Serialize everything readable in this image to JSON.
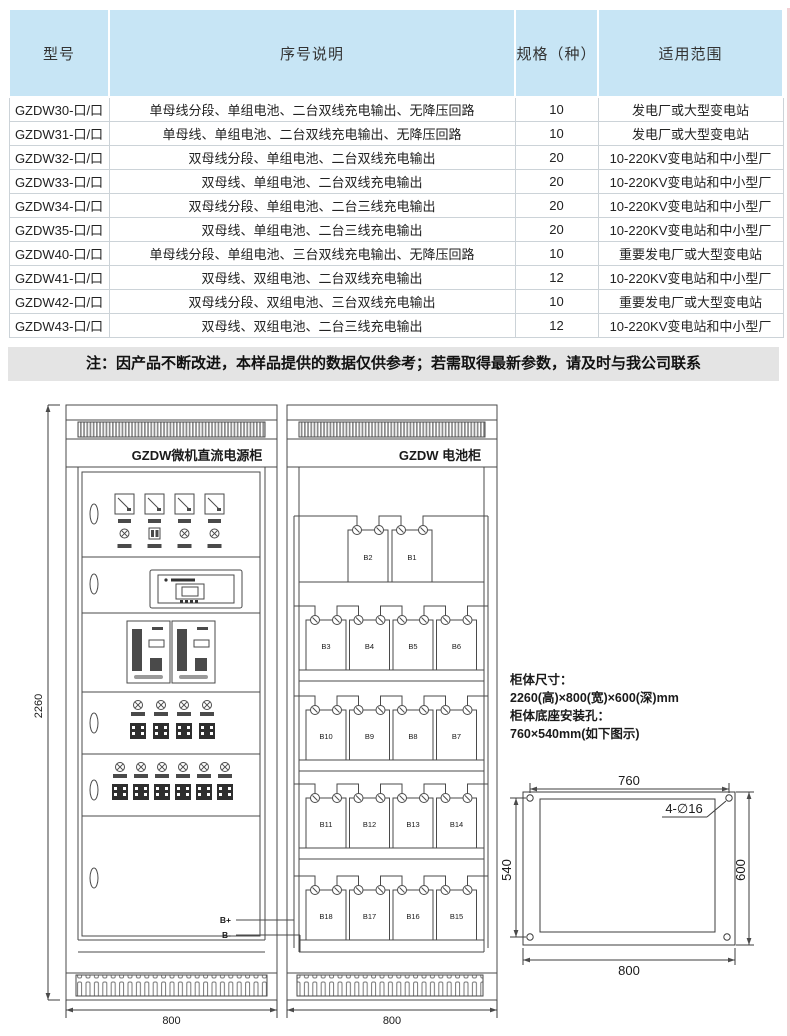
{
  "table": {
    "headers": [
      "型号",
      "序号说明",
      "规格（种）",
      "适用范围"
    ],
    "rows": [
      {
        "model": "GZDW30-口/口",
        "desc": "单母线分段、单组电池、二台双线充电输出、无降压回路",
        "spec": "10",
        "range": "发电厂或大型变电站"
      },
      {
        "model": "GZDW31-口/口",
        "desc": "单母线、单组电池、二台双线充电输出、无降压回路",
        "spec": "10",
        "range": "发电厂或大型变电站"
      },
      {
        "model": "GZDW32-口/口",
        "desc": "双母线分段、单组电池、二台双线充电输出",
        "spec": "20",
        "range": "10-220KV变电站和中小型厂"
      },
      {
        "model": "GZDW33-口/口",
        "desc": "双母线、单组电池、二台双线充电输出",
        "spec": "20",
        "range": "10-220KV变电站和中小型厂"
      },
      {
        "model": "GZDW34-口/口",
        "desc": "双母线分段、单组电池、二台三线充电输出",
        "spec": "20",
        "range": "10-220KV变电站和中小型厂"
      },
      {
        "model": "GZDW35-口/口",
        "desc": "双母线、单组电池、二台三线充电输出",
        "spec": "20",
        "range": "10-220KV变电站和中小型厂"
      },
      {
        "model": "GZDW40-口/口",
        "desc": "单母线分段、单组电池、三台双线充电输出、无降压回路",
        "spec": "10",
        "range": "重要发电厂或大型变电站"
      },
      {
        "model": "GZDW41-口/口",
        "desc": "双母线、双组电池、二台双线充电输出",
        "spec": "12",
        "range": "10-220KV变电站和中小型厂"
      },
      {
        "model": "GZDW42-口/口",
        "desc": "双母线分段、双组电池、三台双线充电输出",
        "spec": "10",
        "range": "重要发电厂或大型变电站"
      },
      {
        "model": "GZDW43-口/口",
        "desc": "双母线、双组电池、二台三线充电输出",
        "spec": "12",
        "range": "10-220KV变电站和中小型厂"
      }
    ]
  },
  "note": "注：因产品不断改进，本样品提供的数据仅供参考；若需取得最新参数，请及时与我公司联系",
  "drawing": {
    "power_cabinet": {
      "title": "GZDW微机直流电源柜"
    },
    "battery_cabinet": {
      "title": "GZDW 电池柜",
      "rows": [
        [
          "B2",
          "B1"
        ],
        [
          "B3",
          "B4",
          "B5",
          "B6"
        ],
        [
          "B10",
          "B9",
          "B8",
          "B7"
        ],
        [
          "B11",
          "B12",
          "B13",
          "B14"
        ],
        [
          "B18",
          "B17",
          "B16",
          "B15"
        ]
      ]
    },
    "terminals": {
      "positive": "B+",
      "negative": "B-"
    },
    "dims": {
      "height": "2260",
      "left_width": "800",
      "right_width": "800"
    },
    "specs": {
      "line1": "柜体尺寸：",
      "line2": "2260(高)×800(宽)×600(深)mm",
      "line3": "柜体底座安装孔：",
      "line4": "760×540mm(如下图示)"
    },
    "base_plan": {
      "top": "760",
      "bottom": "800",
      "left": "540",
      "right": "600",
      "holes": "4-∅16"
    }
  },
  "colors": {
    "header_bg": "#c7e5f5",
    "note_bg": "#e4e4e4",
    "line": "#4a4a4a",
    "edge_pink": "#f4d0d4"
  }
}
